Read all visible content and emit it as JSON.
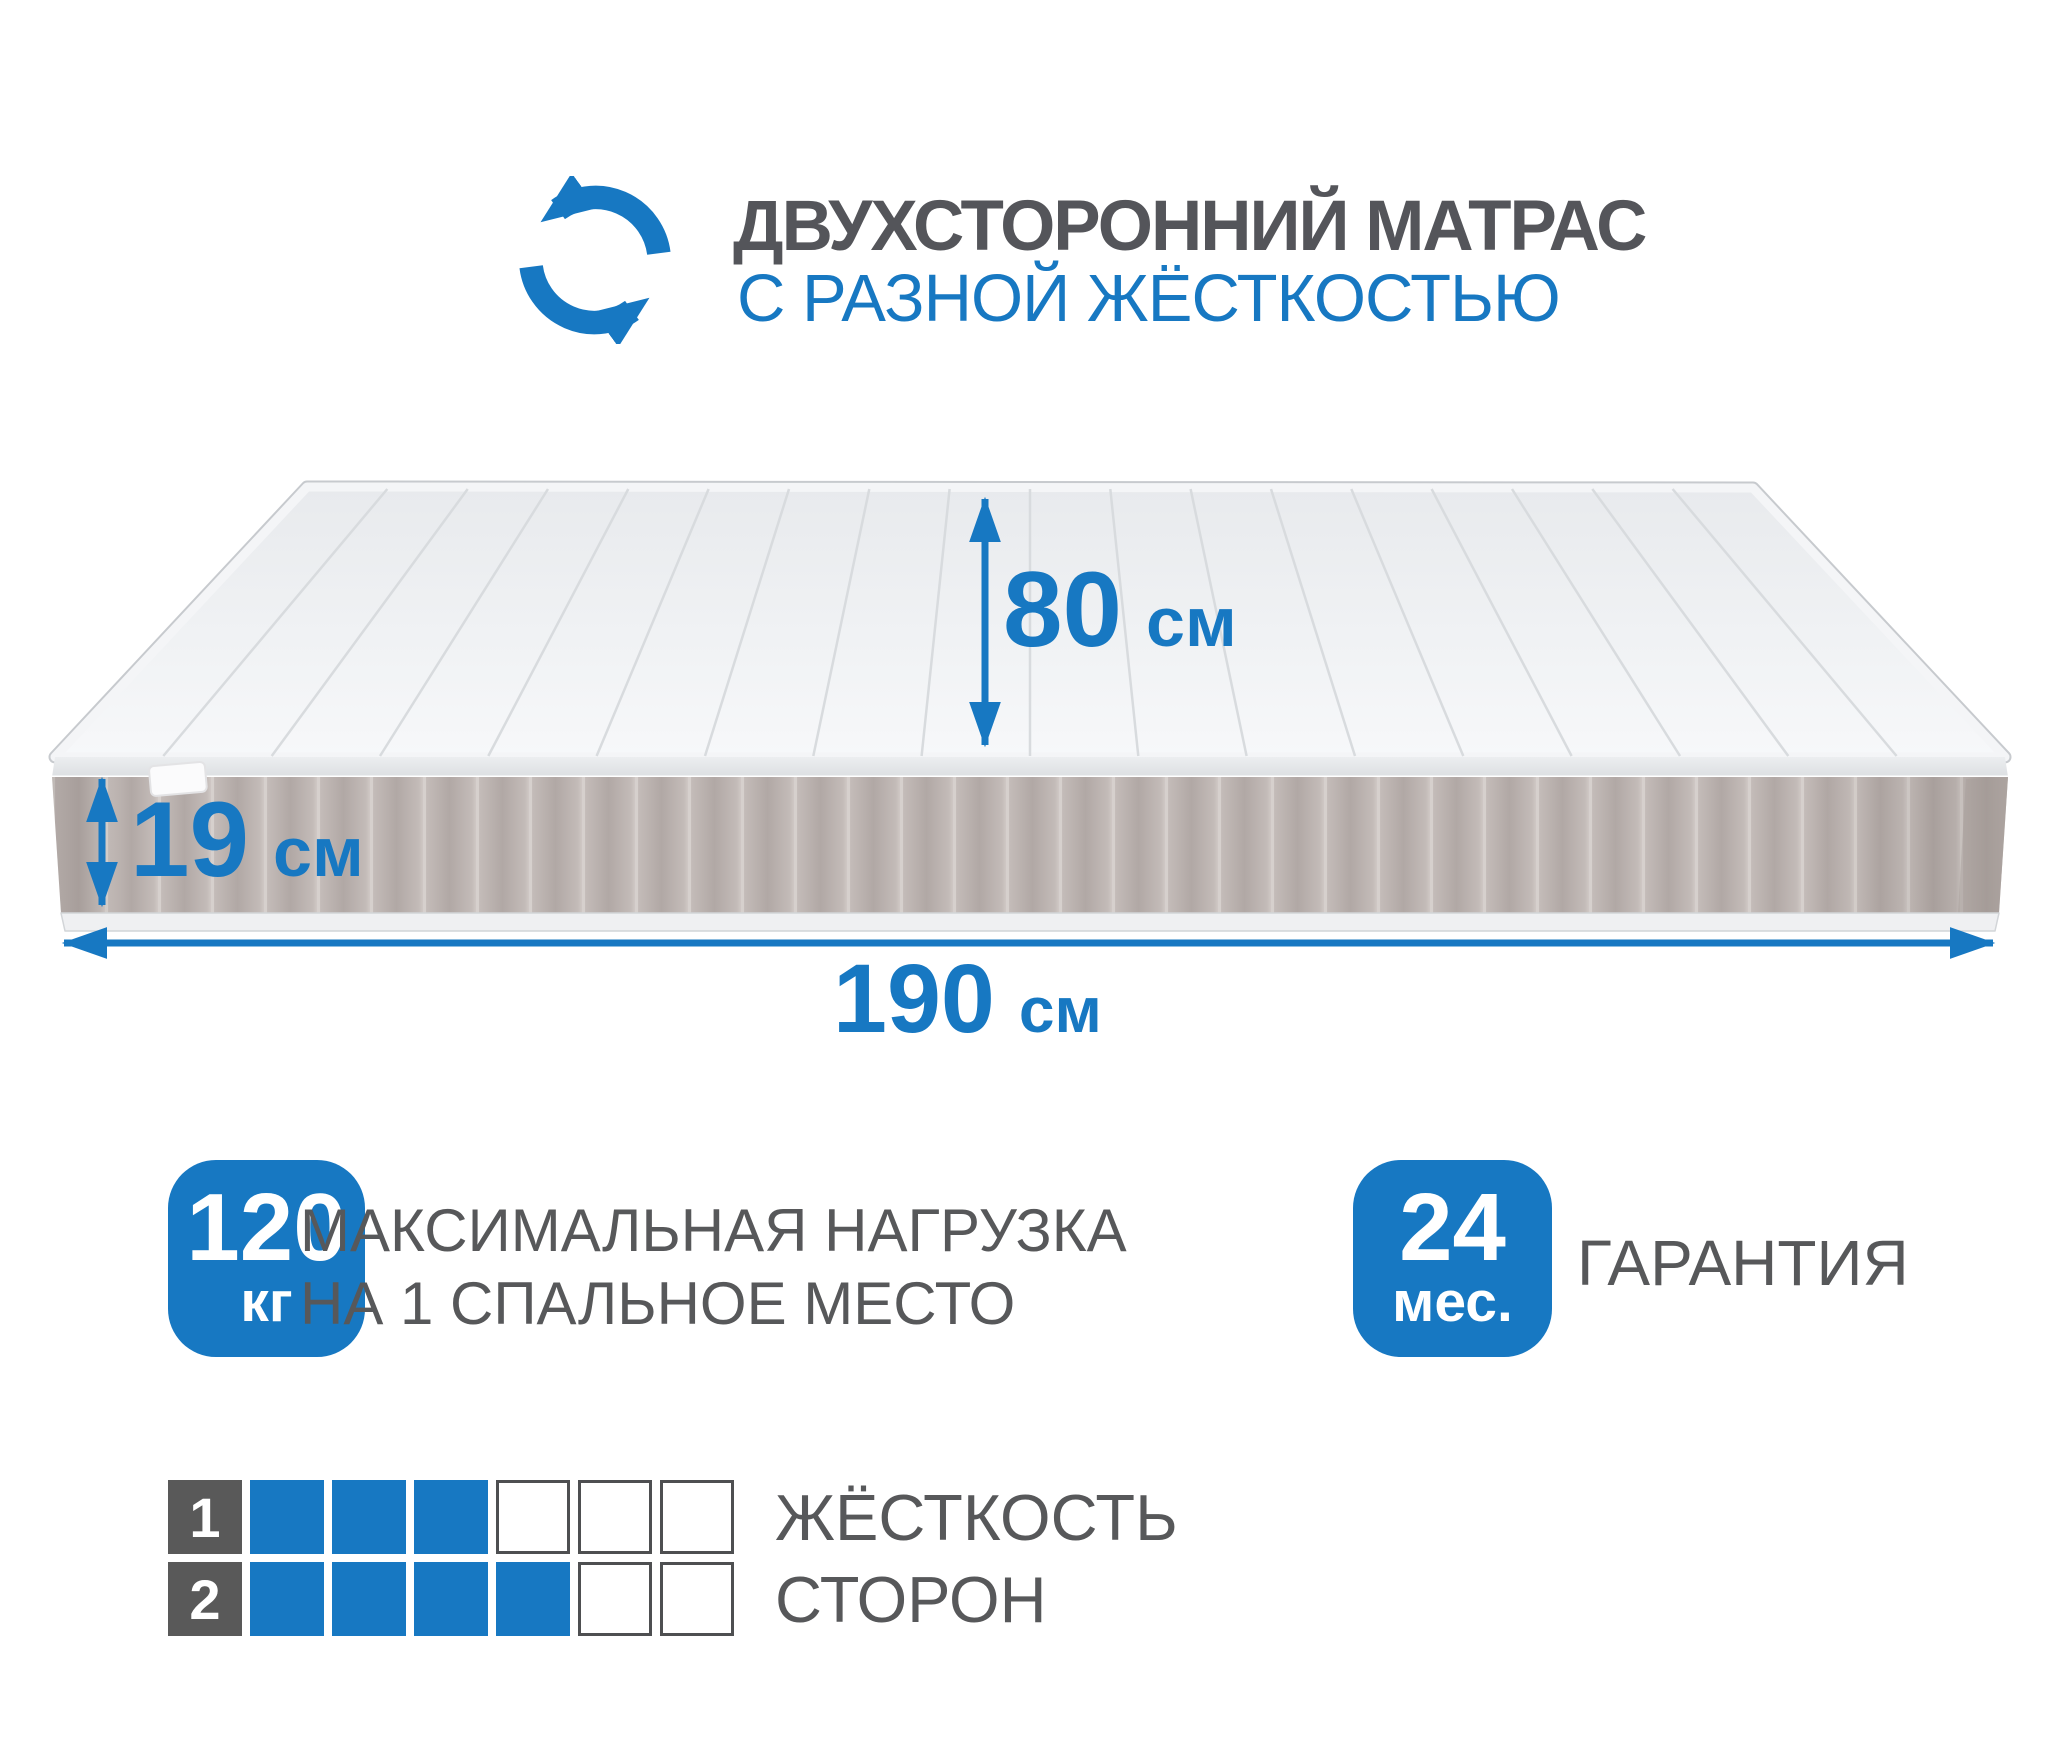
{
  "colors": {
    "accent": "#1778c2",
    "text_gray": "#57585a",
    "scale_dark": "#595959",
    "mattress_side": "#b3aaa7",
    "mattress_top": "#eef0f3"
  },
  "header": {
    "icon": "rotate-arrows-icon",
    "title_line1": "ДВУХСТОРОННИЙ МАТРАС",
    "title_line2": "С РАЗНОЙ ЖЁСТКОСТЬЮ"
  },
  "dimensions": {
    "width": {
      "value": "80",
      "unit": "см"
    },
    "height": {
      "value": "19",
      "unit": "см"
    },
    "length": {
      "value": "190",
      "unit": "см"
    }
  },
  "badges": {
    "max_load": {
      "value": "120",
      "unit": "кг",
      "label_line1": "МАКСИМАЛЬНАЯ НАГРУЗКА",
      "label_line2": "НА 1 СПАЛЬНОЕ МЕСТО"
    },
    "warranty": {
      "value": "24",
      "unit": "мес.",
      "label": "ГАРАНТИЯ"
    }
  },
  "hardness_scale": {
    "label_line1": "ЖЁСТКОСТЬ",
    "label_line2": "СТОРОН",
    "rows": [
      {
        "index": "1",
        "filled": 3,
        "total": 6
      },
      {
        "index": "2",
        "filled": 4,
        "total": 6
      }
    ]
  }
}
